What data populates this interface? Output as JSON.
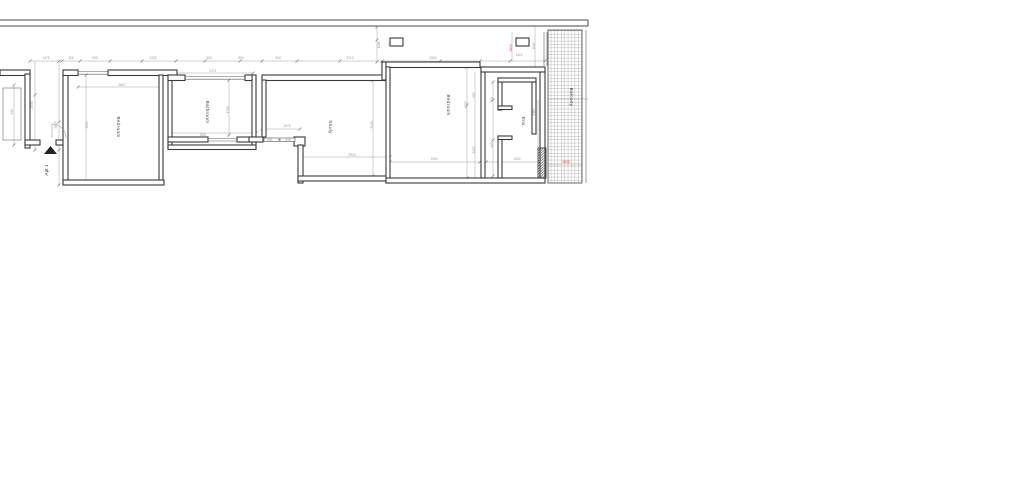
{
  "drawing": {
    "apartment_label": "Apt 1",
    "rooms": [
      {
        "label": "Bedroom"
      },
      {
        "label": "Bathroom"
      },
      {
        "label": "Study"
      },
      {
        "label": "Bedroom"
      },
      {
        "label": "Ens."
      },
      {
        "label": "Balcony"
      }
    ],
    "red_dimensions": [
      {
        "t": "1500"
      },
      {
        "t": "1500"
      }
    ],
    "dimensions": [
      {
        "t": "1475"
      },
      {
        "t": "300"
      },
      {
        "t": "900"
      },
      {
        "t": "2432"
      },
      {
        "t": "300"
      },
      {
        "t": "900"
      },
      {
        "t": "900"
      },
      {
        "t": "3712"
      },
      {
        "t": "2900"
      },
      {
        "t": "1410"
      },
      {
        "t": "5875"
      },
      {
        "t": "2935"
      },
      {
        "t": "2667"
      },
      {
        "t": "2171"
      },
      {
        "t": "1790"
      },
      {
        "t": "800"
      },
      {
        "t": "2935"
      },
      {
        "t": "1475"
      },
      {
        "t": "451"
      },
      {
        "t": "416"
      },
      {
        "t": "2933"
      },
      {
        "t": "4132"
      },
      {
        "t": "2900"
      },
      {
        "t": "1000"
      },
      {
        "t": "989"
      },
      {
        "t": "1193"
      },
      {
        "t": "718"
      },
      {
        "t": "405"
      },
      {
        "t": "1193"
      },
      {
        "t": "610"
      },
      {
        "t": "1530"
      },
      {
        "t": "3110"
      },
      {
        "t": "910"
      },
      {
        "t": "2935"
      }
    ]
  },
  "colors": {
    "wall": "#3a3a3a",
    "dimension_text": "#8b96b6",
    "red_text": "#e03030",
    "dimension_line": "#a3a3a3",
    "background": "#ffffff"
  }
}
